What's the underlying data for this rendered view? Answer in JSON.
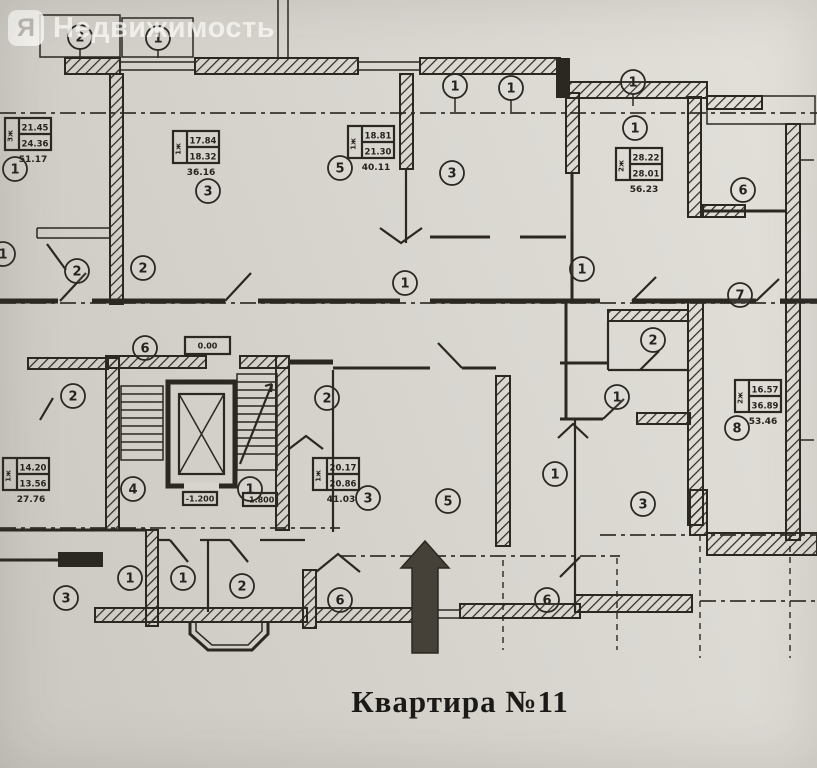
{
  "colors": {
    "paper": "#d8d5cf",
    "ink": "#2b2822",
    "watermark_white": "#fbfaf8"
  },
  "watermark": {
    "logo_letter": "Я",
    "text": "Недвижимость"
  },
  "caption": {
    "text": "Квартира №11"
  },
  "floorplan": {
    "room_circles": [
      {
        "label": "2",
        "x": 80,
        "y": 37
      },
      {
        "label": "1",
        "x": 158,
        "y": 38
      },
      {
        "label": "1",
        "x": 455,
        "y": 86
      },
      {
        "label": "1",
        "x": 511,
        "y": 88
      },
      {
        "label": "1",
        "x": 633,
        "y": 82
      },
      {
        "label": "1",
        "x": 15,
        "y": 169
      },
      {
        "label": "3",
        "x": 208,
        "y": 191
      },
      {
        "label": "5",
        "x": 340,
        "y": 168
      },
      {
        "label": "3",
        "x": 452,
        "y": 173
      },
      {
        "label": "1",
        "x": 635,
        "y": 128
      },
      {
        "label": "6",
        "x": 743,
        "y": 190
      },
      {
        "label": "2",
        "x": 653,
        "y": 340
      },
      {
        "label": "7",
        "x": 740,
        "y": 295
      },
      {
        "label": "1",
        "x": 3,
        "y": 254
      },
      {
        "label": "2",
        "x": 77,
        "y": 271
      },
      {
        "label": "2",
        "x": 143,
        "y": 268
      },
      {
        "label": "1",
        "x": 405,
        "y": 283
      },
      {
        "label": "1",
        "x": 582,
        "y": 269
      },
      {
        "label": "6",
        "x": 145,
        "y": 348
      },
      {
        "label": "2",
        "x": 73,
        "y": 396
      },
      {
        "label": "2",
        "x": 327,
        "y": 398
      },
      {
        "label": "1",
        "x": 617,
        "y": 397
      },
      {
        "label": "8",
        "x": 737,
        "y": 428
      },
      {
        "label": "4",
        "x": 133,
        "y": 489
      },
      {
        "label": "1",
        "x": 250,
        "y": 489
      },
      {
        "label": "3",
        "x": 368,
        "y": 498
      },
      {
        "label": "5",
        "x": 448,
        "y": 501
      },
      {
        "label": "1",
        "x": 555,
        "y": 474
      },
      {
        "label": "3",
        "x": 643,
        "y": 504
      },
      {
        "label": "3",
        "x": 66,
        "y": 598
      },
      {
        "label": "1",
        "x": 130,
        "y": 578
      },
      {
        "label": "1",
        "x": 183,
        "y": 578
      },
      {
        "label": "2",
        "x": 242,
        "y": 586
      },
      {
        "label": "6",
        "x": 340,
        "y": 600
      },
      {
        "label": "6",
        "x": 547,
        "y": 600
      }
    ],
    "stamps": [
      {
        "apt": "3ж",
        "rows": [
          "21.45",
          "24.36"
        ],
        "total": "51.17",
        "x": 5,
        "y": 118
      },
      {
        "apt": "1ж",
        "rows": [
          "17.84",
          "18.32"
        ],
        "total": "36.16",
        "x": 173,
        "y": 131
      },
      {
        "apt": "1ж",
        "rows": [
          "18.81",
          "21.30"
        ],
        "total": "40.11",
        "x": 348,
        "y": 126
      },
      {
        "apt": "2ж",
        "rows": [
          "28.22",
          "28.01"
        ],
        "total": "56.23",
        "x": 616,
        "y": 148
      },
      {
        "apt": "1ж",
        "rows": [
          "14.20",
          "13.56"
        ],
        "total": "27.76",
        "x": 3,
        "y": 458
      },
      {
        "apt": "1ж",
        "rows": [
          "20.17",
          "20.86"
        ],
        "total": "41.03",
        "x": 313,
        "y": 458
      },
      {
        "apt": "2ж",
        "rows": [
          "16.57",
          "36.89"
        ],
        "total": "53.46",
        "x": 735,
        "y": 380
      }
    ],
    "levels": [
      {
        "text": "0.00",
        "x": 185,
        "y": 337,
        "w": 45,
        "h": 17
      },
      {
        "text": "-1.200",
        "x": 183,
        "y": 492,
        "w": 34,
        "h": 13
      },
      {
        "text": "-1.800",
        "x": 243,
        "y": 493,
        "w": 34,
        "h": 13
      }
    ]
  }
}
